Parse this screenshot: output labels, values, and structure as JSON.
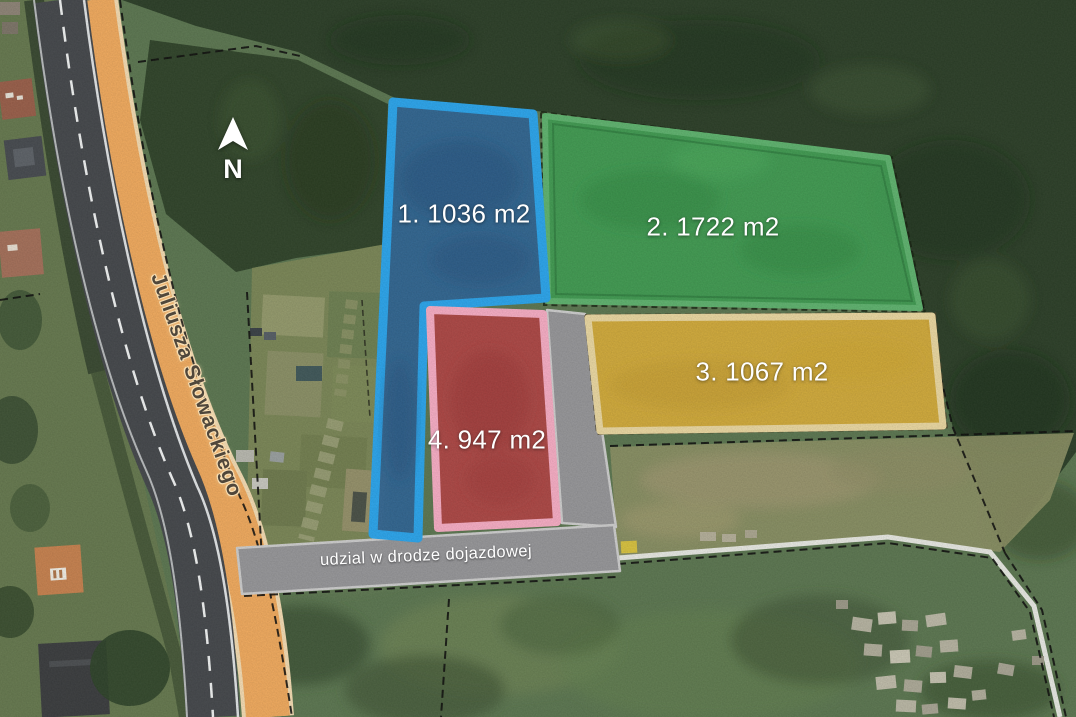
{
  "map": {
    "compass": {
      "label": "N"
    },
    "street": {
      "name": "Juliusza Słowackiego"
    },
    "access_road": {
      "label": "udzial w drodze dojazdowej"
    },
    "plots": [
      {
        "number": 1,
        "label": "1. 1036 m2",
        "area_m2": 1036,
        "fill_color": "#2e6597",
        "border_color": "#2ba6ee"
      },
      {
        "number": 2,
        "label": "2. 1722 m2",
        "area_m2": 1722,
        "fill_color": "#3f9d52",
        "border_color": "#5fb46f"
      },
      {
        "number": 3,
        "label": "3. 1067 m2",
        "area_m2": 1067,
        "fill_color": "#d7ad3a",
        "border_color": "#ecd9a2"
      },
      {
        "number": 4,
        "label": "4. 947 m2",
        "area_m2": 947,
        "fill_color": "#b24545",
        "border_color": "#f9aec6"
      }
    ]
  }
}
